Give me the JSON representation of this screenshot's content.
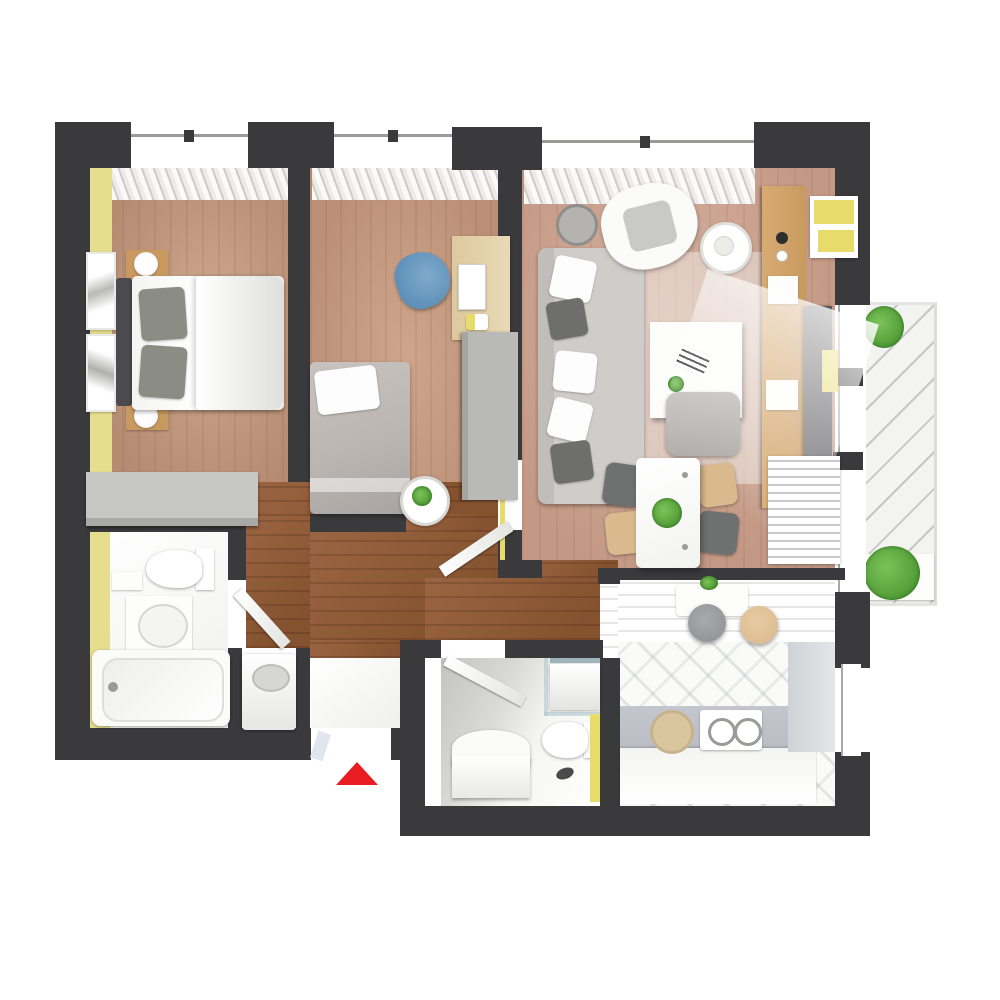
{
  "title": "3d-apartment-floor-plan-top-view",
  "colors": {
    "wall": "#3a3a3c",
    "floor_bedroom": "#b58b72",
    "floor_study": "#bb9077",
    "floor_living": "#c39884",
    "floor_hall": "#84522f",
    "tile": "#efefed",
    "accent_yellow": "#e5df8d",
    "accent_yellow_bright": "#e7dc6a",
    "gray_furniture": "#c7c7c5",
    "dark_panel": "#57575a",
    "wood_furniture": "#c99a60",
    "desk_wood": "#ddc9a0",
    "blue_chair": "#5d8fb7",
    "sofa": "#cecdc9",
    "rug": "#e8e2de",
    "red_arrow": "#ea1c23",
    "plant": "#4f9a34",
    "balcony": "#f3f3f1",
    "brick": "#f6f5f3",
    "counter": "#b9bdc3",
    "stool_beige": "#d8b88e",
    "stool_gray": "#8c8e90",
    "bed_blanket": "#b9b4b0",
    "window_frame": "#ffffff"
  },
  "entrance": {
    "marker": "red-arrow-up"
  },
  "rooms": [
    {
      "name": "bedroom",
      "position": "top-left",
      "accent_wall": "yellow-left",
      "furniture": [
        "double-bed",
        "two-gray-pillows",
        "white-duvet",
        "nightstand-with-lamp-top",
        "nightstand-with-lamp-bottom",
        "two-wall-pictures",
        "gray-wardrobe",
        "window-curtains"
      ]
    },
    {
      "name": "study",
      "position": "top-middle",
      "furniture": [
        "desk-with-laptop",
        "blue-chair",
        "gray-wardrobe",
        "single-bed",
        "round-side-table-with-plant",
        "window-curtains"
      ]
    },
    {
      "name": "living-room",
      "position": "top-right",
      "furniture": [
        "gray-sofa-with-pillows",
        "white-armchair",
        "round-side-tables",
        "coffee-table-with-book-and-plant",
        "gray-pouf",
        "area-rug",
        "tv-wall-unit-wood",
        "tv-panel",
        "yellow-shelf-boxes",
        "window-curtains"
      ]
    },
    {
      "name": "dining-area",
      "position": "center-right",
      "furniture": [
        "white-dining-table-with-plant",
        "chair-gray-top-left",
        "chair-beige-top-right",
        "chair-beige-bottom-left",
        "chair-gray-bottom-right",
        "white-louver-radiator"
      ]
    },
    {
      "name": "bathroom-main",
      "position": "bottom-left",
      "accent_wall": "yellow-left",
      "furniture": [
        "toilet",
        "washbasin",
        "bathtub",
        "open-door"
      ]
    },
    {
      "name": "hallway",
      "position": "center",
      "furniture": [
        "washing-machine",
        "open-doors"
      ]
    },
    {
      "name": "shower-room",
      "position": "bottom-middle",
      "accent_wall": "yellow-right",
      "furniture": [
        "vanity-with-mirror",
        "toilet",
        "bath-seat",
        "glass-partition",
        "slippers",
        "open-door"
      ]
    },
    {
      "name": "kitchen",
      "position": "bottom-right",
      "furniture": [
        "bar-counter-with-rail",
        "bar-stool-gray",
        "bar-stool-beige",
        "l-shaped-counter",
        "round-sink",
        "gas-hob-two-burners",
        "white-brick-walls",
        "window"
      ]
    },
    {
      "name": "balcony",
      "position": "right",
      "furniture": [
        "glass-balustrade",
        "green-plant-top",
        "green-plant-bottom",
        "white-planter"
      ]
    }
  ]
}
